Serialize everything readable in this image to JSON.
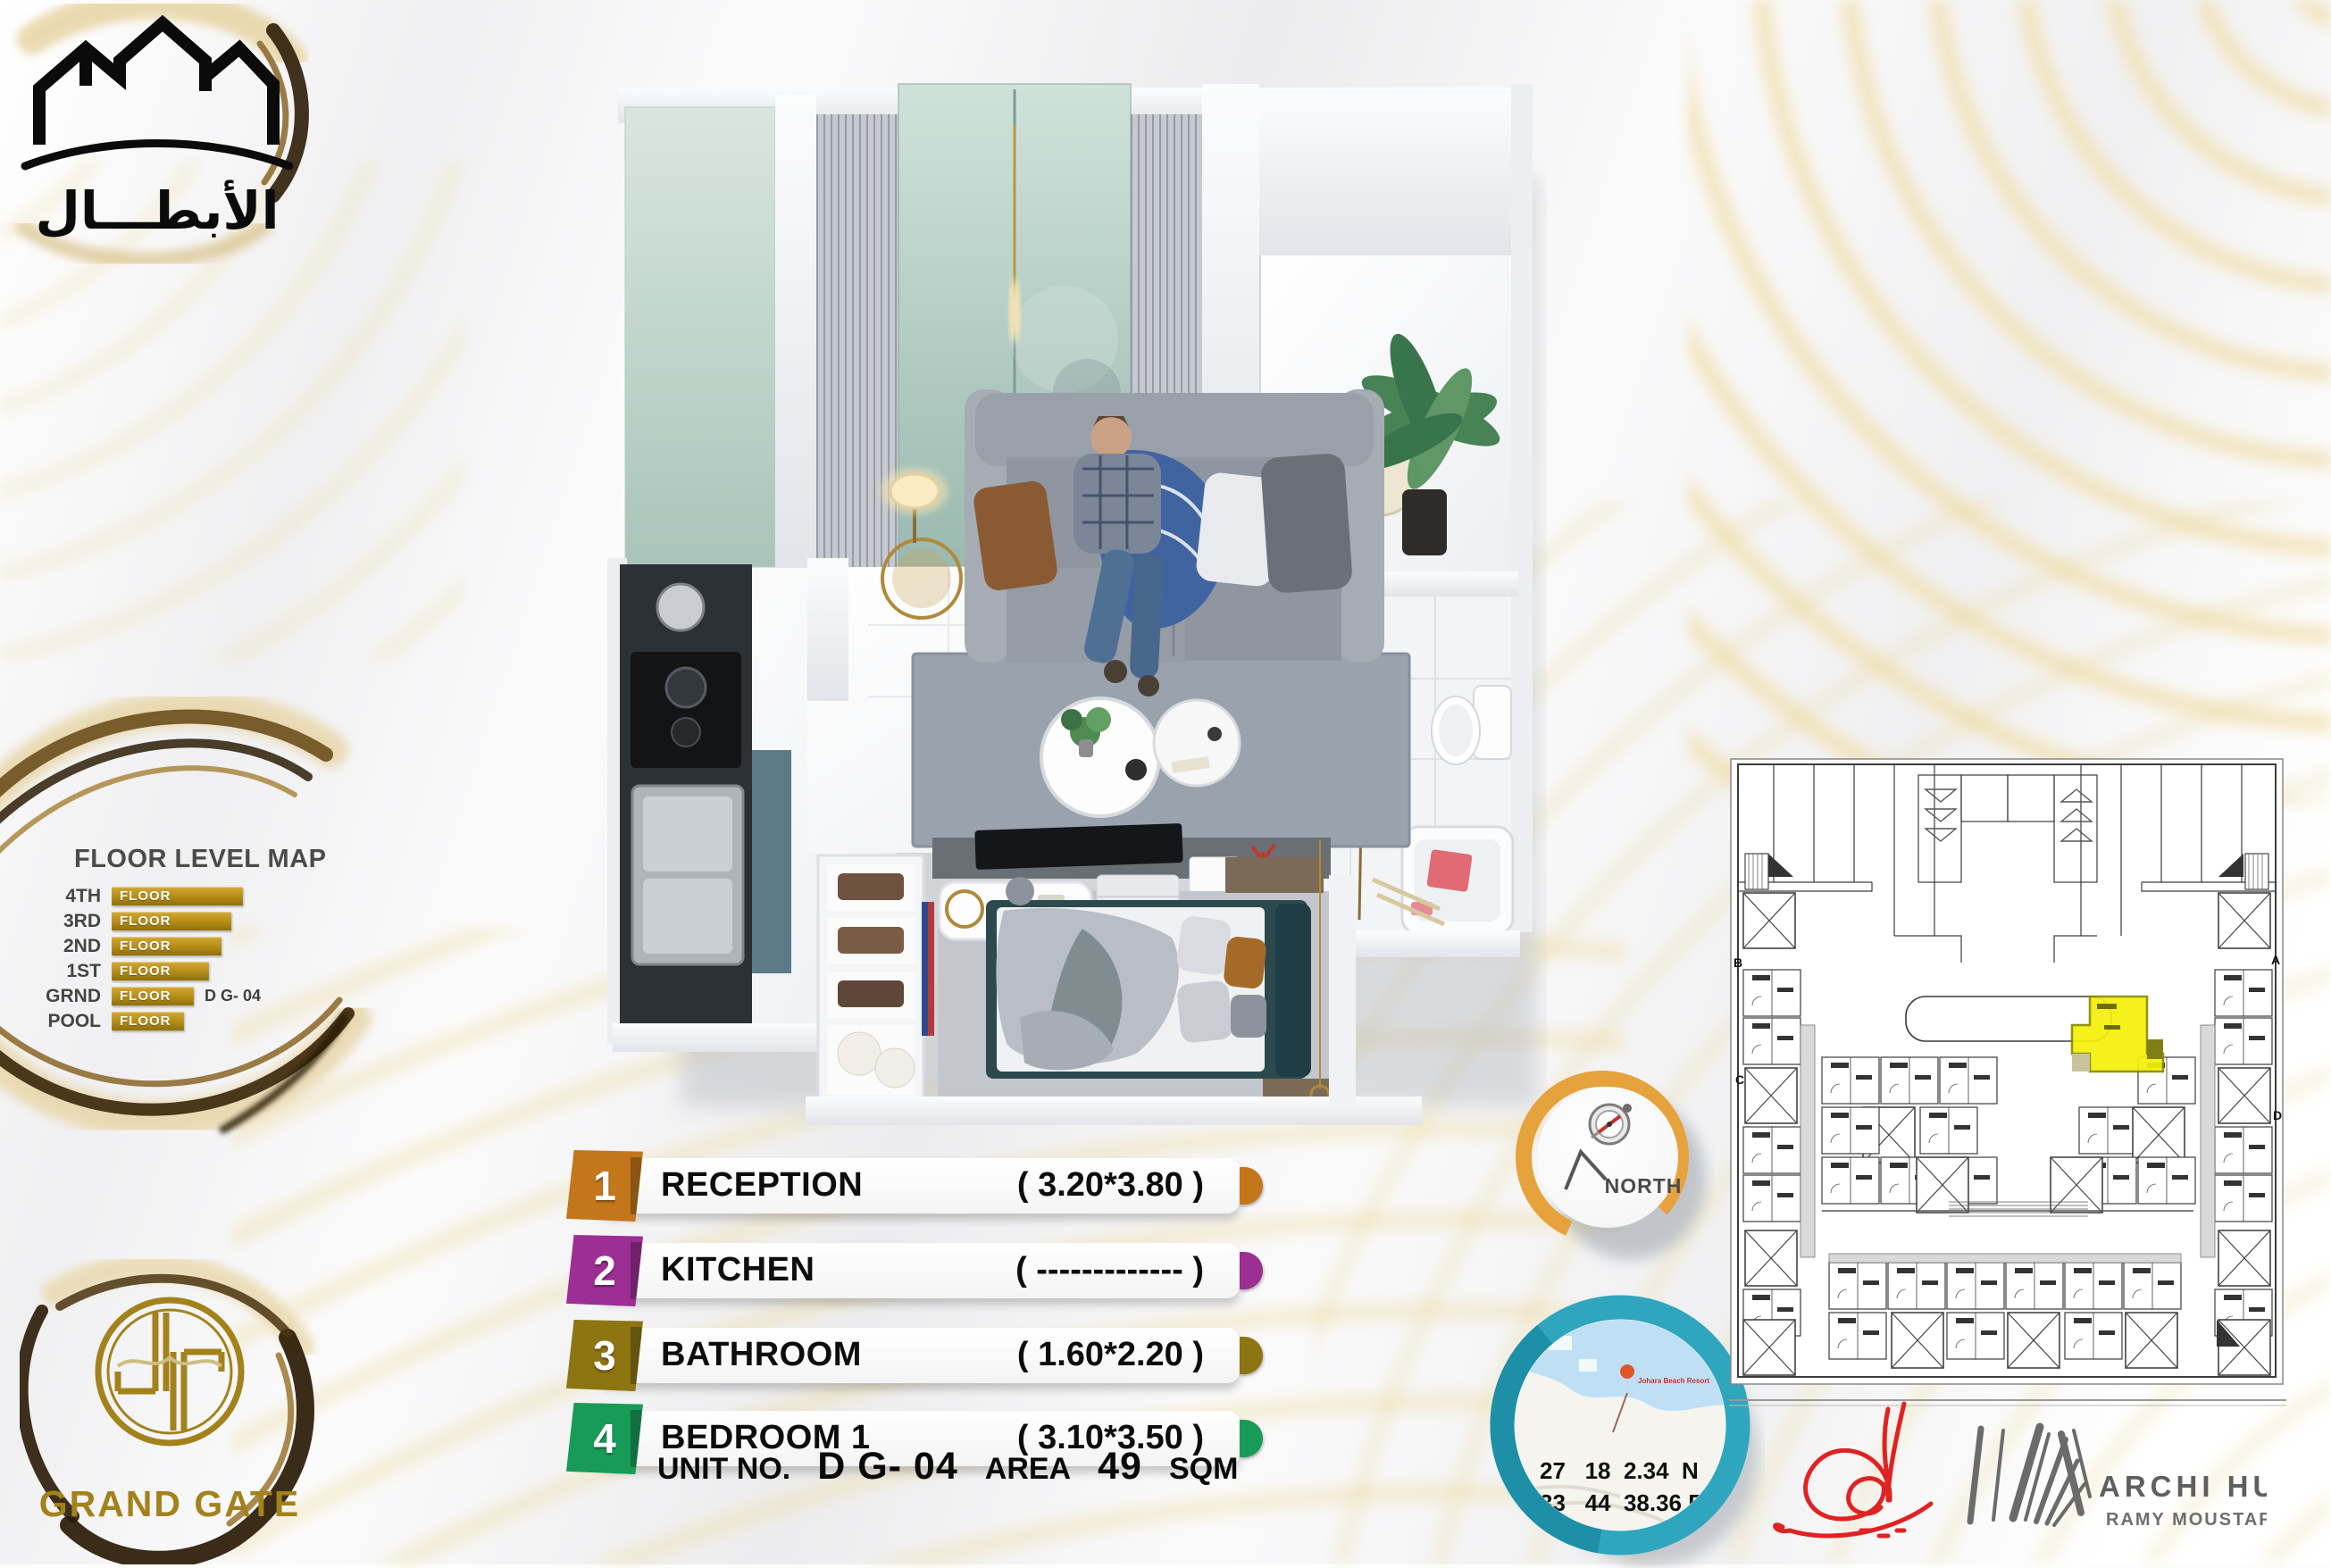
{
  "brand": {
    "developer_logo_text": "الأبطـــال",
    "project_name": "GRAND GATE"
  },
  "floor_map": {
    "title": "FLOOR LEVEL MAP",
    "bar_label": "FLOOR",
    "unit_note": "D G- 04",
    "levels": [
      {
        "label": "4TH"
      },
      {
        "label": "3RD"
      },
      {
        "label": "2ND"
      },
      {
        "label": "1ST"
      },
      {
        "label": "GRND"
      },
      {
        "label": "POOL"
      }
    ]
  },
  "legend": {
    "items": [
      {
        "num": "1",
        "name": "RECEPTION",
        "dims": "( 3.20*3.80 )",
        "color": "#C4761B"
      },
      {
        "num": "2",
        "name": "KITCHEN",
        "dims": "( ------------- )",
        "color": "#9C2E94"
      },
      {
        "num": "3",
        "name": "BATHROOM",
        "dims": "( 1.60*2.20 )",
        "color": "#8D7512"
      },
      {
        "num": "4",
        "name": "BEDROOM 1",
        "dims": "( 3.10*3.50 )",
        "color": "#189B57"
      }
    ]
  },
  "unit_info": {
    "unit_no_label": "UNIT NO.",
    "unit_no": "D G- 04",
    "area_label": "AREA",
    "area_value": "49",
    "area_unit": "SQM"
  },
  "compass": {
    "label": "NORTH"
  },
  "location": {
    "lat": "27   18  2.34  N",
    "lng": "33   44  38.36 E",
    "pin_label": "Johara Beach Resort"
  },
  "site_plan": {
    "corner_labels": [
      "A",
      "B",
      "C",
      "D"
    ]
  },
  "studio": {
    "name": "ARCHI  HUB",
    "architect": "RAMY MOUSTAFA"
  }
}
